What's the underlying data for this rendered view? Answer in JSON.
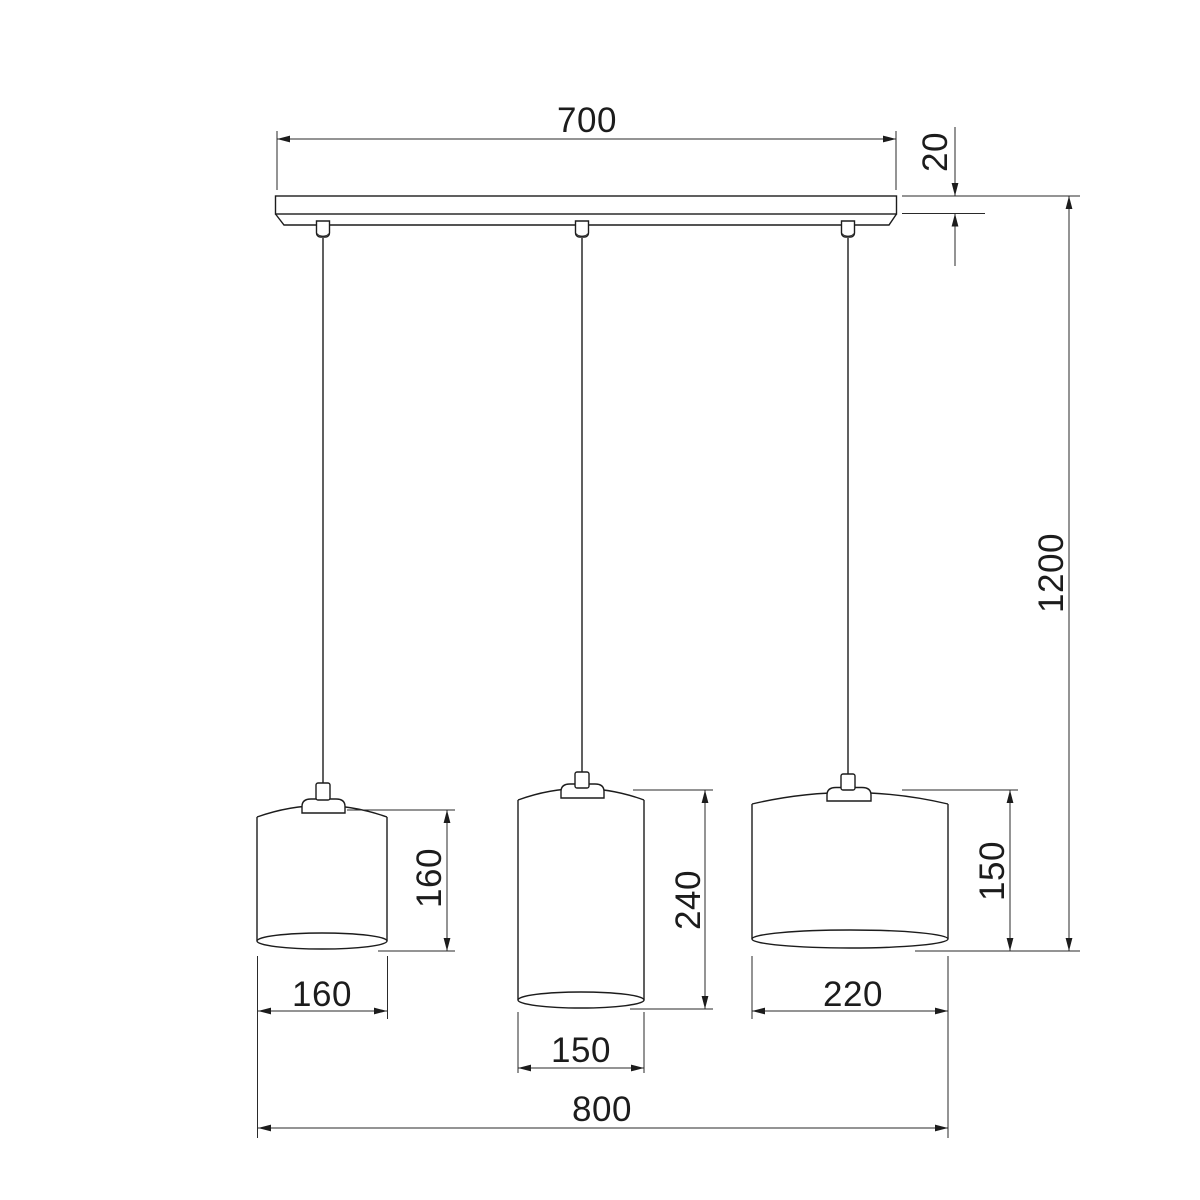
{
  "drawing": {
    "kind": "pendant-lamp-dimension-drawing",
    "background_color": "#ffffff",
    "line_color": "#1c1c1c",
    "labels": {
      "canopy_width": "700",
      "canopy_thickness": "20",
      "total_height": "1200",
      "left_shade_height": "160",
      "left_shade_diameter": "160",
      "middle_shade_height": "240",
      "middle_shade_diameter": "150",
      "right_shade_height": "150",
      "right_shade_diameter": "220",
      "overall_width": "800"
    }
  }
}
